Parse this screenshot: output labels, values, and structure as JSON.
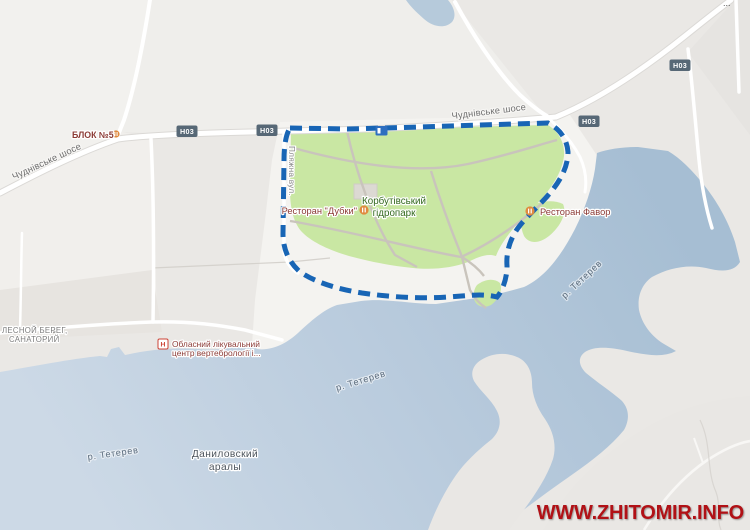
{
  "map": {
    "roads": {
      "chudnivske_shose": "Чуднівське шосе",
      "plyazhna_street": "Пляжна вул.",
      "h03_shield": "Н03",
      "truncated_label_dots": "..."
    },
    "park": {
      "name_line1": "Корбутівський",
      "name_line2": "гідропарк"
    },
    "pois": {
      "blok5": "БЛОК №5",
      "restaurant_dubki": "Ресторан \"Дубки\"",
      "restaurant_favor": "Ресторан Фавор",
      "sanatorium_line1": "ЛЕСНОЙ БЕРЕГ,",
      "sanatorium_line2": "САНАТОРИЙ",
      "med_center_line1": "Обласний лікувальний",
      "med_center_line2": "центр вертебрології і...",
      "hospital_icon_letter": "Н",
      "danylivski_line1": "Даниловский",
      "danylivski_line2": "аралы"
    },
    "water": {
      "river_label": "р. Тетерев"
    },
    "watermark": "WWW.ZHITOMIR.INFO",
    "colors": {
      "park_green": "#c9e7a3",
      "park_border_blue": "#1865b5",
      "water_dark": "#a6bed3",
      "water_light": "#ccd9e6",
      "land_gray": "#eae8e5",
      "road_white": "#ffffff",
      "poi_red": "#8c3b36",
      "park_label_green": "#33691e",
      "shield_slate": "#576876",
      "watermark_red": "#b11116"
    }
  }
}
